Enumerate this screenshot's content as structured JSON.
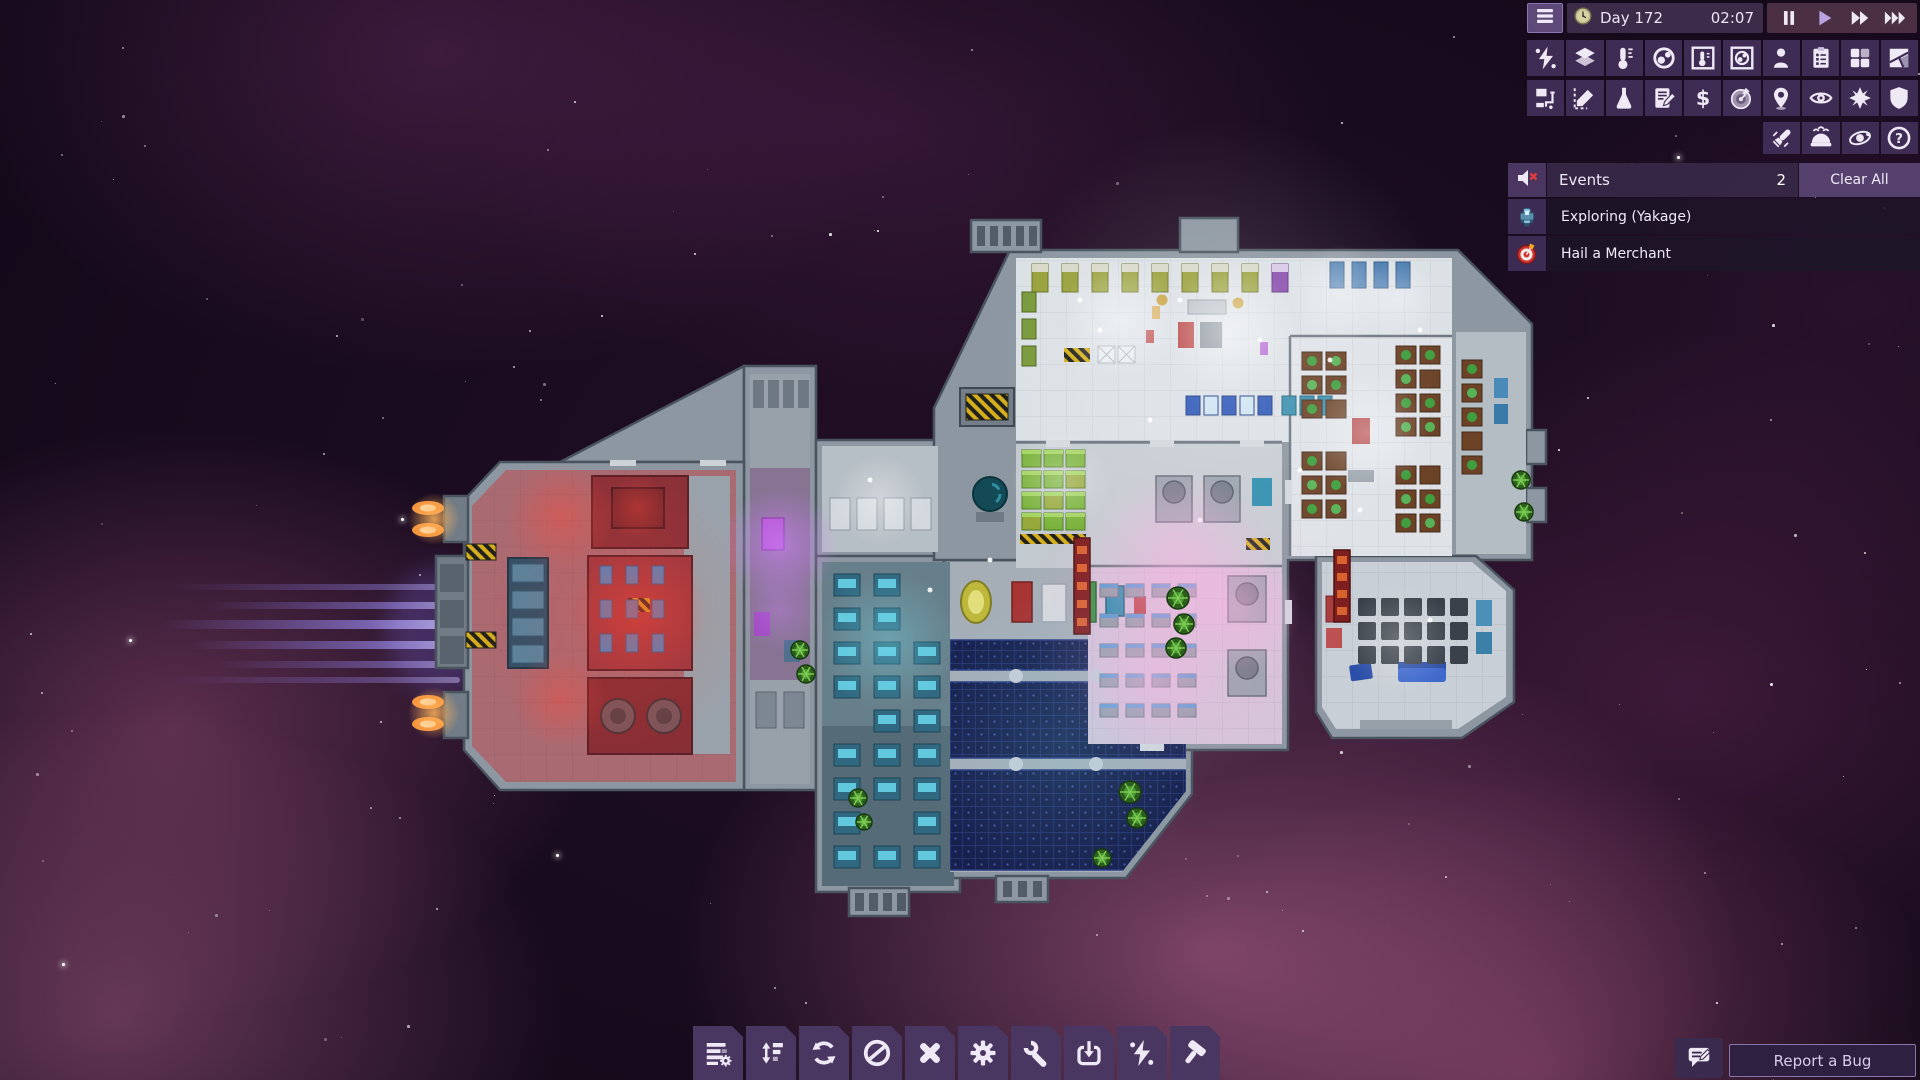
{
  "topbar": {
    "day": "Day 172",
    "time": "02:07",
    "playback": [
      {
        "name": "pause",
        "icon": "pause",
        "active": false
      },
      {
        "name": "play",
        "icon": "play",
        "active": true
      },
      {
        "name": "fast-forward",
        "icon": "ff",
        "active": false
      },
      {
        "name": "fastest-forward",
        "icon": "fff",
        "active": false
      }
    ]
  },
  "overlay_toolbar": {
    "row1": [
      {
        "name": "power-overlay",
        "icon": "power"
      },
      {
        "name": "floors-overlay",
        "icon": "floors"
      },
      {
        "name": "temperature-overlay",
        "icon": "temperature"
      },
      {
        "name": "gas-overlay",
        "icon": "gas"
      },
      {
        "name": "temperature-detail-overlay",
        "icon": "temp-frame"
      },
      {
        "name": "gas-detail-overlay",
        "icon": "gas-frame"
      },
      {
        "name": "crew-overlay",
        "icon": "crew"
      },
      {
        "name": "tasks-overlay",
        "icon": "tasks"
      },
      {
        "name": "facilities-overlay",
        "icon": "rooms"
      },
      {
        "name": "hull-overlay",
        "icon": "hull"
      }
    ],
    "row2": [
      {
        "name": "logistics-overlay",
        "icon": "logistics"
      },
      {
        "name": "zones-overlay",
        "icon": "zones"
      },
      {
        "name": "research-overlay",
        "icon": "research"
      },
      {
        "name": "log-overlay",
        "icon": "log"
      },
      {
        "name": "trade-overlay",
        "icon": "trade"
      },
      {
        "name": "missions-overlay",
        "icon": "missions"
      },
      {
        "name": "navigation-overlay",
        "icon": "navigation"
      },
      {
        "name": "visibility-overlay",
        "icon": "visibility"
      },
      {
        "name": "combat-overlay",
        "icon": "combat"
      },
      {
        "name": "shields-overlay",
        "icon": "shield"
      }
    ],
    "row3": [
      {
        "name": "pod-launch",
        "icon": "pod"
      },
      {
        "name": "hibernation",
        "icon": "dome"
      },
      {
        "name": "system-view",
        "icon": "orbit"
      },
      {
        "name": "help",
        "icon": "help"
      }
    ]
  },
  "events": {
    "title": "Events",
    "count": "2",
    "clear_all_label": "Clear All",
    "items": [
      {
        "icon": "event-ship",
        "label": "Exploring (Yakage)"
      },
      {
        "icon": "event-target",
        "label": "Hail a Merchant"
      }
    ]
  },
  "bottom_toolbar": [
    {
      "name": "manage-menu",
      "icon": "manage"
    },
    {
      "name": "priorities",
      "icon": "priorities"
    },
    {
      "name": "rotate",
      "icon": "rotate"
    },
    {
      "name": "forbid",
      "icon": "forbid"
    },
    {
      "name": "deconstruct",
      "icon": "deconstruct"
    },
    {
      "name": "operations",
      "icon": "gear"
    },
    {
      "name": "repair",
      "icon": "repair"
    },
    {
      "name": "deploy",
      "icon": "deploy"
    },
    {
      "name": "power-toggle",
      "icon": "power"
    },
    {
      "name": "build",
      "icon": "build"
    }
  ],
  "report_bug": {
    "label": "Report a Bug"
  },
  "colors": {
    "hud_tile": "#3e2c54",
    "hud_tile_bottom": "#4a3761",
    "accent_play": "#b9a2e2",
    "event_row_bg": "#1f1628",
    "alert_red": "#e23b3b"
  }
}
